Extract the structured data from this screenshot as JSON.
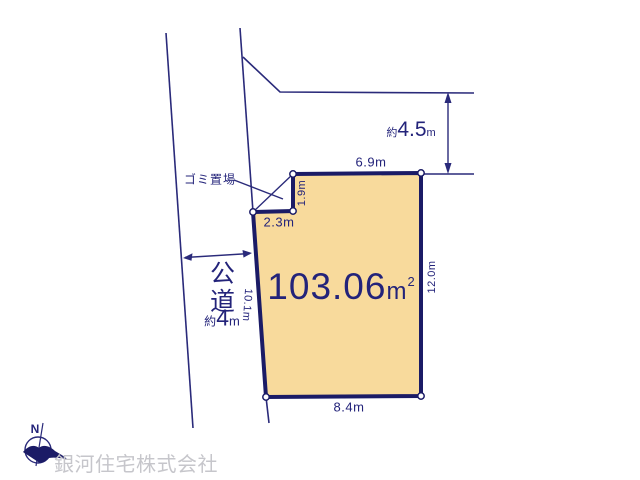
{
  "colors": {
    "line_navy": "#2a2a7a",
    "plot_border": "#1b1b66",
    "plot_fill": "#f8da9c",
    "text_navy": "#23237a",
    "watermark_gray": "#c6c6cb"
  },
  "plot": {
    "area": {
      "value": "103.06",
      "unit": "m",
      "sup": "2"
    },
    "dim_top": "6.9m",
    "dim_right": "12.0m",
    "dim_bottom": "8.4m",
    "dim_left": "10.1m",
    "notch_width": "2.3m",
    "notch_height": "1.9m"
  },
  "garbage": {
    "label": "ゴミ置場"
  },
  "road": {
    "name_vertical": "公道",
    "width": {
      "prefix": "約",
      "value": "4",
      "unit": "m"
    }
  },
  "setback": {
    "prefix": "約",
    "value": "4.5",
    "unit": "m"
  },
  "compass": {
    "north_label": "N"
  },
  "footer": {
    "company": "銀河住宅株式会社"
  }
}
